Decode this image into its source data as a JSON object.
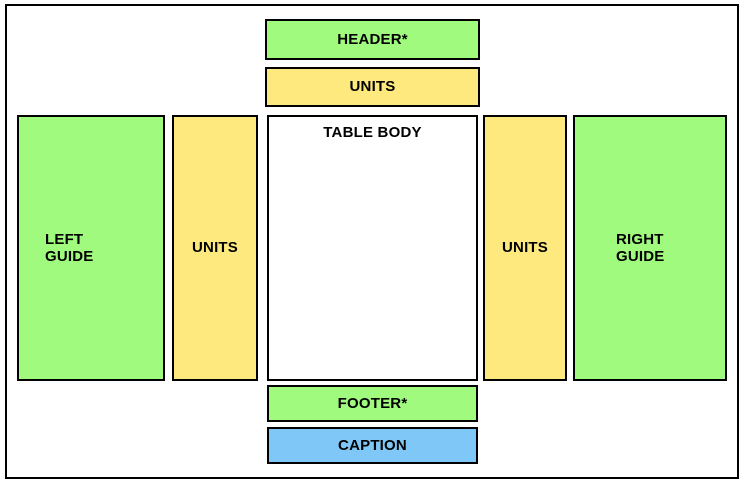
{
  "diagram": {
    "colors": {
      "guide_green": "#A0FA7E",
      "units_yellow": "#FDE97E",
      "caption_blue": "#7EC7F7",
      "body_white": "#FFFFFF",
      "border_black": "#000000"
    },
    "boxes": {
      "header": {
        "label": "HEADER*"
      },
      "units_top": {
        "label": "UNITS"
      },
      "left_guide": {
        "line1": "LEFT",
        "line2": "GUIDE"
      },
      "units_left": {
        "label": "UNITS"
      },
      "table_body": {
        "label": "TABLE BODY"
      },
      "units_right": {
        "label": "UNITS"
      },
      "right_guide": {
        "line1": "RIGHT",
        "line2": "GUIDE"
      },
      "footer": {
        "label": "FOOTER*"
      },
      "caption": {
        "label": "CAPTION"
      }
    }
  }
}
